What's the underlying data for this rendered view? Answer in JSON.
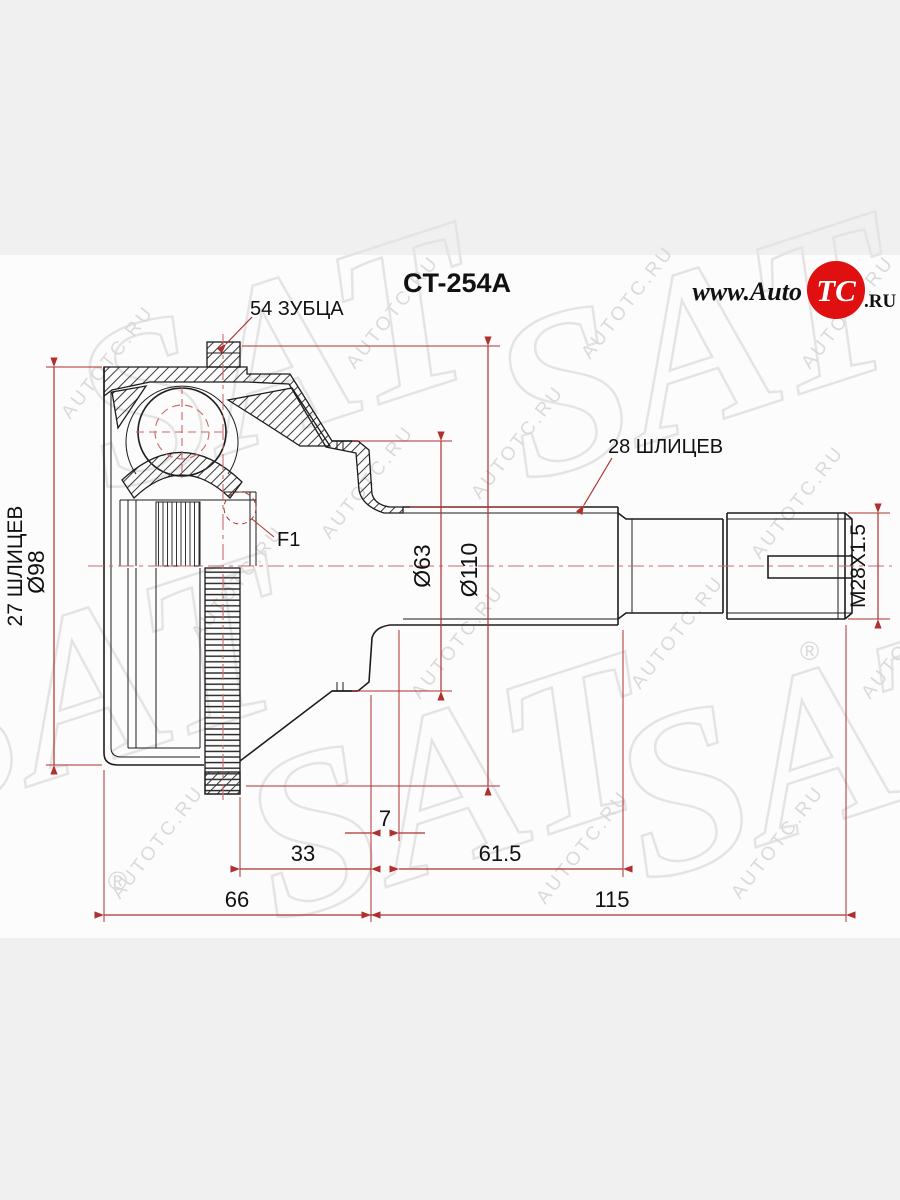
{
  "page": {
    "background": "#f0f0f0",
    "paper": "#fcfcfc"
  },
  "title": {
    "part_number": "CT-254A"
  },
  "logo": {
    "prefix": "www.Auto",
    "badge": "TC",
    "suffix": ".RU",
    "badge_color": "#e01010"
  },
  "labels": {
    "teeth_count": "54 ЗУБЦА",
    "shaft_splines": "28 ШЛИЦЕВ",
    "hub_splines": "27 ШЛИЦЕВ",
    "outer_diameter": "Ø98",
    "boot_diameter": "Ø63",
    "ring_diameter": "Ø110",
    "thread": "M28X1.5",
    "flange_mark": "F1"
  },
  "dimensions": {
    "groove_width": "7",
    "hub_to_groove": "33",
    "spline_length": "61.5",
    "bell_length": "66",
    "shaft_length": "115"
  },
  "watermark": {
    "brand": "SAT",
    "site": "AUTOTC.RU",
    "registered": "®"
  },
  "colors": {
    "dimension_red": "#b03030",
    "centerline_red": "#cc6b6b",
    "line_black": "#1c1c1c",
    "watermark_gray": "#e3e3e3"
  }
}
